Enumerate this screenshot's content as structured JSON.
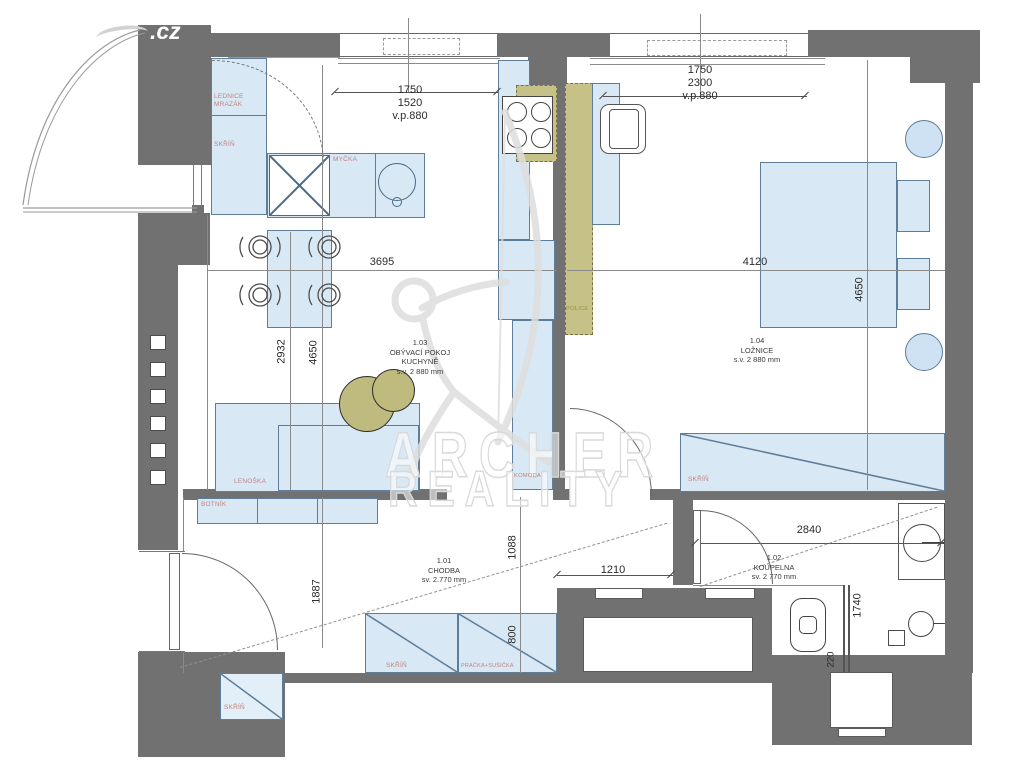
{
  "watermark": {
    "cz": ".cz",
    "word1": "ARCHER",
    "word2": "REALITY"
  },
  "rooms": {
    "living": "1.03\nOBÝVACÍ POKOJ\nKUCHYNĚ\ns.v. 2 880 mm",
    "bedroom": "1.04\nLOŽNICE\ns.v. 2 880 mm",
    "hall": "1.01\nCHODBA\nsv. 2.770 mm",
    "bath": "1.02\nKOUPELNA\nsv. 2 770 mm"
  },
  "dims": {
    "kitchen_window": "1750\n1520\nv.p.880",
    "bedroom_window": "1750\n2300\nv.p.880",
    "living_width": "3695",
    "living_d1": "2932",
    "living_d2": "4650",
    "bedroom_width": "4120",
    "bedroom_depth": "4650",
    "hall_depth": "1887",
    "hall_d1": "1088",
    "hall_door": "1210",
    "hall_d2": "800",
    "bath_width": "2840",
    "bath_depth": "1740",
    "bath_wall": "220"
  },
  "furniture": {
    "fridge": "LEDNICE\nMRAZÁK",
    "wardrobe_kitchen": "SKŘÍŇ",
    "dishwasher": "MYČKA",
    "daybed": "LENOŠKA",
    "shoe_rack": "BOTNÍK",
    "dresser": "KOMODA",
    "shelves": "POLICE",
    "wardrobe_bedroom": "SKŘÍŇ",
    "wardrobe_hall": "SKŘÍŇ",
    "washer_dryer": "PRAČKA+SUŠIČKA",
    "wardrobe_niche": "SKŘÍŇ"
  },
  "colors": {
    "wall": "#717171",
    "furniture_fill": "#d9e8f5",
    "furniture_border": "#5d7d99",
    "accent_olive": "#c6c187",
    "label_red": "#c4827f",
    "dim_text": "#2b2b2b"
  }
}
